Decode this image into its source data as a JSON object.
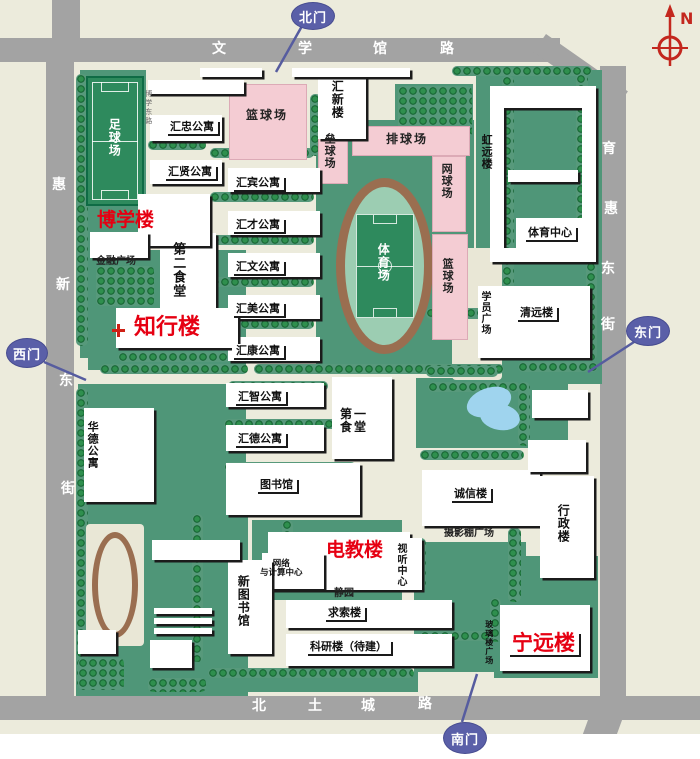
{
  "map": {
    "colors": {
      "background": "#ecebdc",
      "road": "#a3a3a3",
      "lawn": "#4f9678",
      "field_green": "#2e8a5d",
      "court_pink": "#f4ccd3",
      "track_brown": "#9a6e50",
      "building": "#ffffff",
      "highlight_red": "#e60012",
      "gate_purple": "#5a5fa8",
      "pond_blue": "#9fd4ee",
      "compass_red": "#c3271e"
    },
    "compass": {
      "n": "N"
    },
    "roads": [
      [
        0,
        38,
        560,
        24,
        0
      ],
      [
        546,
        34,
        100,
        22,
        35
      ],
      [
        600,
        66,
        26,
        634,
        0
      ],
      [
        596,
        698,
        32,
        70,
        20
      ],
      [
        52,
        0,
        28,
        44,
        0
      ],
      [
        46,
        42,
        28,
        656,
        0
      ],
      [
        0,
        696,
        700,
        24,
        0
      ]
    ],
    "white_margins": [
      [
        0,
        734,
        700,
        25
      ]
    ],
    "greens": [
      [
        80,
        70,
        66,
        288
      ],
      [
        88,
        250,
        158,
        120
      ],
      [
        395,
        84,
        78,
        58
      ],
      [
        316,
        120,
        158,
        248
      ],
      [
        476,
        70,
        126,
        190
      ],
      [
        476,
        252,
        126,
        132
      ],
      [
        416,
        378,
        152,
        70
      ],
      [
        78,
        384,
        168,
        128
      ],
      [
        76,
        506,
        172,
        190
      ],
      [
        252,
        520,
        150,
        80
      ],
      [
        414,
        542,
        112,
        62
      ],
      [
        414,
        598,
        84,
        74
      ],
      [
        524,
        556,
        74,
        60
      ],
      [
        494,
        592,
        104,
        86
      ],
      [
        526,
        652,
        70,
        26
      ],
      [
        420,
        620,
        78,
        22
      ],
      [
        80,
        658,
        60,
        36
      ],
      [
        148,
        672,
        270,
        20
      ]
    ],
    "plazas": [
      [
        452,
        248,
        50,
        132
      ]
    ],
    "trees_h": [
      [
        180,
        80,
        42,
        10
      ],
      [
        452,
        66,
        140,
        10
      ],
      [
        210,
        148,
        104,
        10
      ],
      [
        148,
        140,
        58,
        10
      ],
      [
        210,
        192,
        104,
        10
      ],
      [
        210,
        235,
        104,
        10
      ],
      [
        210,
        277,
        104,
        10
      ],
      [
        210,
        319,
        104,
        10
      ],
      [
        118,
        352,
        132,
        10
      ],
      [
        100,
        364,
        148,
        10
      ],
      [
        254,
        364,
        250,
        10
      ],
      [
        518,
        362,
        80,
        10
      ],
      [
        224,
        419,
        126,
        10
      ],
      [
        228,
        381,
        100,
        10
      ],
      [
        224,
        462,
        132,
        10
      ],
      [
        426,
        308,
        72,
        11
      ],
      [
        426,
        366,
        72,
        11
      ],
      [
        420,
        450,
        104,
        10
      ],
      [
        208,
        668,
        206,
        10
      ],
      [
        526,
        663,
        62,
        10
      ],
      [
        420,
        631,
        76,
        10
      ],
      [
        148,
        678,
        58,
        14
      ],
      [
        428,
        382,
        92,
        10
      ]
    ],
    "trees_v": [
      [
        76,
        74,
        12,
        272
      ],
      [
        76,
        388,
        12,
        298
      ],
      [
        310,
        94,
        11,
        62
      ],
      [
        502,
        76,
        12,
        282
      ],
      [
        576,
        74,
        12,
        162
      ],
      [
        508,
        528,
        13,
        74
      ],
      [
        282,
        520,
        11,
        36
      ],
      [
        414,
        538,
        12,
        52
      ],
      [
        192,
        514,
        11,
        148
      ],
      [
        490,
        598,
        11,
        44
      ],
      [
        586,
        262,
        11,
        98
      ],
      [
        518,
        382,
        12,
        64
      ]
    ],
    "trees_grid": [
      [
        96,
        266,
        58,
        40
      ],
      [
        398,
        86,
        74,
        52
      ],
      [
        78,
        658,
        46,
        32
      ]
    ],
    "courts": [
      [
        229,
        84,
        78,
        76
      ],
      [
        318,
        128,
        30,
        56
      ],
      [
        352,
        126,
        118,
        30
      ],
      [
        432,
        156,
        34,
        76
      ],
      [
        432,
        234,
        36,
        106
      ]
    ],
    "football_field": [
      86,
      76,
      58,
      130
    ],
    "stadium_track": [
      336,
      178,
      97,
      176
    ],
    "small_track": {
      "pad": [
        86,
        524,
        58,
        122
      ],
      "ring": [
        92,
        532,
        46,
        106
      ]
    },
    "pond": [
      [
        466,
        388,
        46,
        28,
        -20
      ],
      [
        480,
        404,
        40,
        26,
        10
      ]
    ],
    "buildings": [
      [
        148,
        80,
        96,
        14
      ],
      [
        318,
        77,
        48,
        62
      ],
      [
        150,
        115,
        72,
        26
      ],
      [
        150,
        160,
        72,
        24
      ],
      [
        228,
        168,
        92,
        24
      ],
      [
        228,
        211,
        92,
        24
      ],
      [
        228,
        253,
        92,
        24
      ],
      [
        228,
        295,
        92,
        24
      ],
      [
        228,
        337,
        92,
        24
      ],
      [
        226,
        383,
        98,
        24
      ],
      [
        226,
        425,
        98,
        26
      ],
      [
        160,
        233,
        56,
        76
      ],
      [
        138,
        194,
        72,
        52
      ],
      [
        90,
        232,
        58,
        26
      ],
      [
        116,
        308,
        122,
        40
      ],
      [
        84,
        408,
        70,
        94
      ],
      [
        226,
        463,
        134,
        52
      ],
      [
        332,
        377,
        60,
        82
      ],
      [
        268,
        532,
        142,
        58
      ],
      [
        262,
        553,
        62,
        36
      ],
      [
        388,
        538,
        34,
        52
      ],
      [
        286,
        600,
        166,
        28
      ],
      [
        286,
        634,
        166,
        32
      ],
      [
        228,
        560,
        44,
        94
      ],
      [
        422,
        470,
        118,
        56
      ],
      [
        540,
        476,
        54,
        102
      ],
      [
        478,
        286,
        112,
        72
      ],
      [
        516,
        218,
        78,
        44
      ],
      [
        500,
        605,
        90,
        66
      ],
      [
        490,
        86,
        106,
        22
      ],
      [
        490,
        108,
        14,
        140
      ],
      [
        582,
        108,
        14,
        140
      ],
      [
        508,
        170,
        70,
        12
      ],
      [
        490,
        248,
        106,
        14
      ],
      [
        528,
        440,
        58,
        32
      ],
      [
        532,
        390,
        56,
        28
      ],
      [
        150,
        640,
        42,
        28
      ],
      [
        154,
        608,
        58,
        6
      ],
      [
        154,
        618,
        58,
        6
      ],
      [
        154,
        628,
        58,
        6
      ],
      [
        152,
        540,
        88,
        20
      ],
      [
        78,
        630,
        38,
        24
      ],
      [
        200,
        68,
        62,
        9
      ],
      [
        292,
        68,
        118,
        9
      ]
    ],
    "labels": [
      {
        "t": "汇忠公寓",
        "x": 166,
        "y": 120,
        "k": "plate"
      },
      {
        "t": "汇贤公寓",
        "x": 164,
        "y": 165,
        "k": "plate"
      },
      {
        "t": "汇宾公寓",
        "x": 232,
        "y": 176,
        "k": "plate"
      },
      {
        "t": "汇才公寓",
        "x": 232,
        "y": 218,
        "k": "plate"
      },
      {
        "t": "汇文公寓",
        "x": 232,
        "y": 260,
        "k": "plate"
      },
      {
        "t": "汇美公寓",
        "x": 232,
        "y": 302,
        "k": "plate"
      },
      {
        "t": "汇康公寓",
        "x": 232,
        "y": 344,
        "k": "plate"
      },
      {
        "t": "汇智公寓",
        "x": 234,
        "y": 390,
        "k": "plate"
      },
      {
        "t": "汇德公寓",
        "x": 234,
        "y": 432,
        "k": "plate"
      },
      {
        "t": "图书馆",
        "x": 256,
        "y": 478,
        "k": "plate"
      },
      {
        "t": "求索楼",
        "x": 324,
        "y": 606,
        "k": "plate"
      },
      {
        "t": "科研楼（待建）",
        "x": 306,
        "y": 640,
        "k": "plate"
      },
      {
        "t": "诚信楼",
        "x": 450,
        "y": 487,
        "k": "plate"
      },
      {
        "t": "清远楼",
        "x": 516,
        "y": 306,
        "k": "plate"
      },
      {
        "t": "体育中心",
        "x": 524,
        "y": 226,
        "k": "plate"
      },
      {
        "t": "汇新楼",
        "x": 330,
        "y": 80,
        "k": "v",
        "f": 12
      },
      {
        "t": "第二食堂",
        "x": 170,
        "y": 242,
        "k": "v",
        "f": 13
      },
      {
        "t": "新图书馆",
        "x": 236,
        "y": 575,
        "k": "v",
        "f": 12
      },
      {
        "t": "华德公寓",
        "x": 86,
        "y": 421,
        "k": "v"
      },
      {
        "t": "行政楼",
        "x": 556,
        "y": 504,
        "k": "v",
        "f": 12
      },
      {
        "t": "视听中心",
        "x": 395,
        "y": 543,
        "k": "v",
        "f": 10
      },
      {
        "t": "学员广场",
        "x": 479,
        "y": 291,
        "k": "v",
        "f": 10
      },
      {
        "t": "虹远楼",
        "x": 480,
        "y": 134,
        "k": "v"
      },
      {
        "t": "玻璃楼广场",
        "x": 484,
        "y": 620,
        "k": "v",
        "f": 8
      },
      {
        "t": "足球场",
        "x": 107,
        "y": 118,
        "k": "v-white"
      },
      {
        "t": "体育场",
        "x": 376,
        "y": 243,
        "k": "v-white"
      },
      {
        "t": "垒球场",
        "x": 323,
        "y": 133,
        "k": "v-pink"
      },
      {
        "t": "网球场",
        "x": 440,
        "y": 163,
        "k": "v-pink"
      },
      {
        "t": "篮球场",
        "x": 441,
        "y": 258,
        "k": "v-pink"
      },
      {
        "t": "排球场",
        "x": 386,
        "y": 133,
        "k": "pink"
      },
      {
        "t": "篮球场",
        "x": 246,
        "y": 109,
        "k": "pink"
      },
      {
        "t": "第一\n食堂",
        "x": 340,
        "y": 408,
        "k": "two"
      },
      {
        "t": "金融广场",
        "x": 96,
        "y": 256,
        "k": "small"
      },
      {
        "t": "摄影棚广场",
        "x": 444,
        "y": 528,
        "k": "small"
      },
      {
        "t": "静园",
        "x": 334,
        "y": 588,
        "k": "small"
      },
      {
        "t": "网络\n与计算中心",
        "x": 260,
        "y": 560,
        "k": "small2"
      },
      {
        "t": "博学东路",
        "x": 144,
        "y": 90,
        "k": "tiny-v"
      },
      {
        "t": "博学楼",
        "x": 97,
        "y": 210,
        "k": "red"
      },
      {
        "t": "知行楼",
        "x": 134,
        "y": 316,
        "k": "red",
        "f": 22
      },
      {
        "t": "电教楼",
        "x": 326,
        "y": 540,
        "k": "red"
      },
      {
        "t": "宁远楼",
        "x": 508,
        "y": 632,
        "k": "plate-red"
      },
      {
        "t": "",
        "x": 112,
        "y": 324,
        "k": "icon"
      },
      {
        "t": "文",
        "x": 212,
        "y": 42,
        "k": "road"
      },
      {
        "t": "学",
        "x": 298,
        "y": 42,
        "k": "road"
      },
      {
        "t": "馆",
        "x": 373,
        "y": 42,
        "k": "road"
      },
      {
        "t": "路",
        "x": 440,
        "y": 42,
        "k": "road"
      },
      {
        "t": "惠",
        "x": 52,
        "y": 178,
        "k": "road"
      },
      {
        "t": "新",
        "x": 56,
        "y": 278,
        "k": "road"
      },
      {
        "t": "东",
        "x": 59,
        "y": 374,
        "k": "road"
      },
      {
        "t": "街",
        "x": 61,
        "y": 482,
        "k": "road"
      },
      {
        "t": "育",
        "x": 602,
        "y": 142,
        "k": "road"
      },
      {
        "t": "惠",
        "x": 604,
        "y": 202,
        "k": "road"
      },
      {
        "t": "东",
        "x": 601,
        "y": 262,
        "k": "road"
      },
      {
        "t": "街",
        "x": 601,
        "y": 318,
        "k": "road"
      },
      {
        "t": "北",
        "x": 252,
        "y": 699,
        "k": "road"
      },
      {
        "t": "土",
        "x": 308,
        "y": 699,
        "k": "road"
      },
      {
        "t": "城",
        "x": 361,
        "y": 699,
        "k": "road"
      },
      {
        "t": "路",
        "x": 418,
        "y": 697,
        "k": "road"
      }
    ],
    "gates": [
      {
        "n": "north-gate-balloon",
        "t": "北门",
        "x": 291,
        "y": 2,
        "w": 42,
        "h": 26,
        "tail": [
          302,
          26,
          276,
          72
        ]
      },
      {
        "n": "west-gate-balloon",
        "t": "西门",
        "x": 6,
        "y": 338,
        "w": 40,
        "h": 28,
        "tail": [
          44,
          362,
          86,
          380
        ]
      },
      {
        "n": "east-gate-balloon",
        "t": "东门",
        "x": 626,
        "y": 316,
        "w": 42,
        "h": 28,
        "tail": [
          634,
          342,
          588,
          372
        ]
      },
      {
        "n": "south-gate-balloon",
        "t": "南门",
        "x": 443,
        "y": 722,
        "w": 42,
        "h": 30,
        "tail": [
          462,
          722,
          477,
          674
        ]
      }
    ]
  }
}
